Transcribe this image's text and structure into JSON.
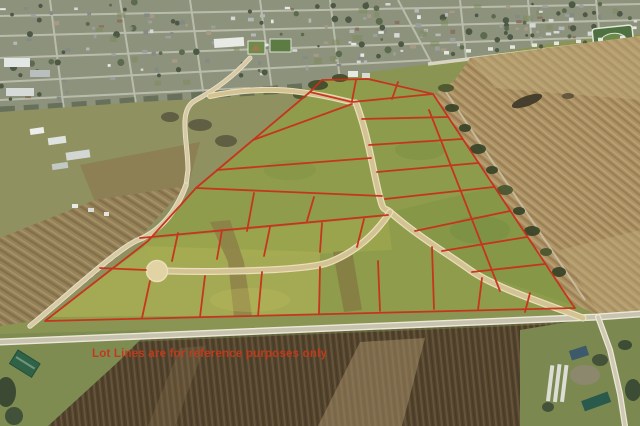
{
  "overlay": {
    "disclaimer": "Lot Lines are for reference purposes only"
  },
  "colors": {
    "lot_line": "#c9301b",
    "disclaimer_text": "#c2391b",
    "road_tan": "#d3c293",
    "grass_green": "#8e9c4b",
    "plowed_tan": "#ac9265",
    "plowed_dark": "#51422c"
  },
  "features": [
    "small town at top",
    "subdivision lots outlined in red",
    "cul-de-sac street",
    "country road along bottom",
    "plowed farm fields"
  ]
}
